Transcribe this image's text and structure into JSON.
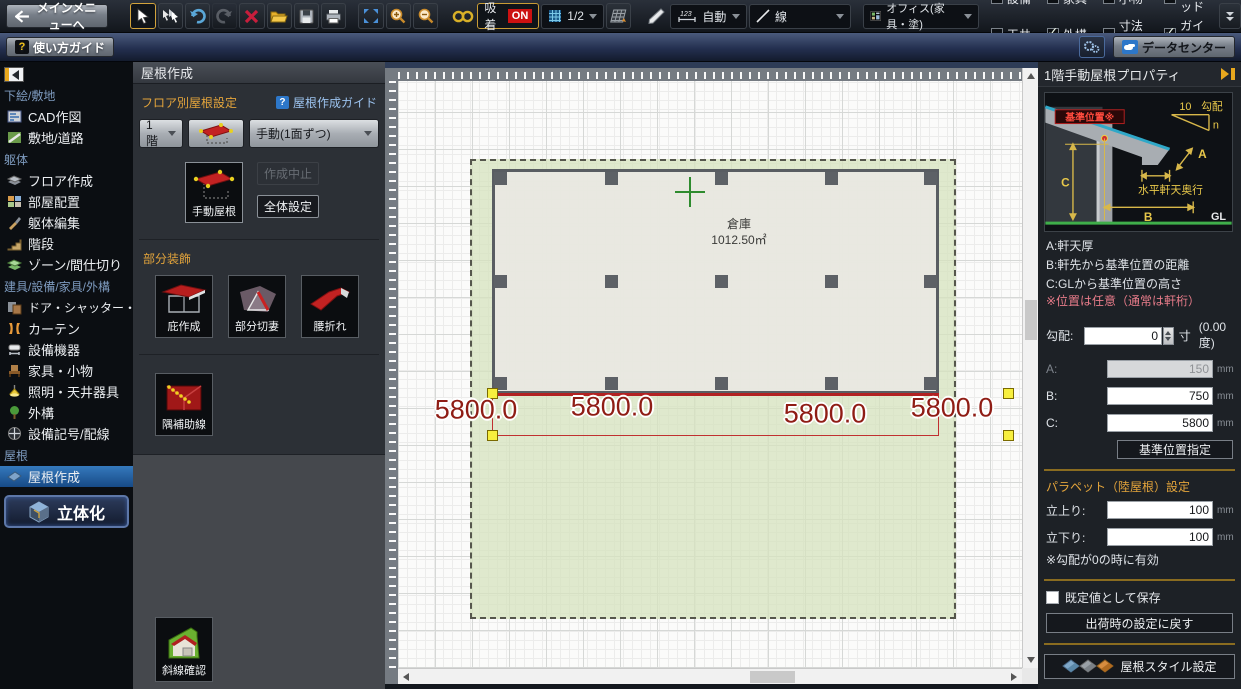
{
  "toolbar": {
    "main_menu_label": "メインメニューへ",
    "snap_label": "吸着",
    "snap_state": "ON",
    "grid_scale": "1/2",
    "dim_icon_text": "123",
    "dim_mode": "自動",
    "line_type": "線",
    "template_name": "オフィス(家具・塗)",
    "checkboxes": [
      {
        "label": "設備",
        "checked": false
      },
      {
        "label": "家具",
        "checked": false
      },
      {
        "label": "小物",
        "checked": false
      },
      {
        "label": "グリッド",
        "checked": true
      },
      {
        "label": "天井",
        "checked": false
      },
      {
        "label": "外構",
        "checked": true
      },
      {
        "label": "寸法線",
        "checked": false
      },
      {
        "label": "ガイド線",
        "checked": true
      }
    ]
  },
  "guide_bar": {
    "help_glyph": "?",
    "usage_guide": "使い方ガイド",
    "data_center": "データセンター"
  },
  "sidebar": {
    "sections": [
      {
        "label": "下絵/敷地",
        "items": [
          {
            "label": "CAD作図"
          },
          {
            "label": "敷地/道路"
          }
        ]
      },
      {
        "label": "躯体",
        "items": [
          {
            "label": "フロア作成"
          },
          {
            "label": "部屋配置"
          },
          {
            "label": "躯体編集"
          },
          {
            "label": "階段"
          },
          {
            "label": "ゾーン/間仕切り"
          }
        ]
      },
      {
        "label": "建具/設備/家具/外構",
        "items": [
          {
            "label": "ドア・シャッター・窓"
          },
          {
            "label": "カーテン"
          },
          {
            "label": "設備機器"
          },
          {
            "label": "家具・小物"
          },
          {
            "label": "照明・天井器具"
          },
          {
            "label": "外構"
          },
          {
            "label": "設備記号/配線"
          }
        ]
      },
      {
        "label": "屋根",
        "items": [
          {
            "label": "屋根作成",
            "selected": true
          }
        ]
      }
    ],
    "solid_button": "立体化"
  },
  "panel": {
    "title": "屋根作成",
    "floor_setting_label": "フロア別屋根設定",
    "guide_glyph": "?",
    "guide_link": "屋根作成ガイド",
    "floor_select": "1階",
    "method_select": "手動(1面ずつ)",
    "manual_roof": "手動屋根",
    "cancel_create": "作成中止",
    "overall_setting": "全体設定",
    "decoration_label": "部分装飾",
    "deco_buttons": [
      {
        "label": "庇作成"
      },
      {
        "label": "部分切妻"
      },
      {
        "label": "腰折れ"
      }
    ],
    "aux_button": "隅補助線",
    "slant_check": "斜線確認"
  },
  "canvas": {
    "room": {
      "name": "倉庫",
      "area": "1012.50㎡"
    },
    "dim_labels": [
      "5800.0",
      "5800.0",
      "5800.0",
      "5800.0"
    ]
  },
  "properties": {
    "title": "1階手動屋根プロパティ",
    "diagram": {
      "base_label": "基準位置※",
      "slope_num": "10",
      "slope_label": "勾配",
      "slope_n": "n",
      "a": "A",
      "b": "B",
      "c": "C",
      "eave_label": "水平軒天奥行",
      "gl": "GL"
    },
    "notes": [
      "A:軒天厚",
      "B:軒先から基準位置の距離",
      "C:GLから基準位置の高さ"
    ],
    "note_warning": "※位置は任意（通常は軒桁）",
    "slope": {
      "label": "勾配:",
      "value": "0",
      "unit": "寸",
      "degrees": "(0.00度)"
    },
    "fields": [
      {
        "label": "A:",
        "value": "150",
        "unit": "mm",
        "disabled": true
      },
      {
        "label": "B:",
        "value": "750",
        "unit": "mm",
        "disabled": false
      },
      {
        "label": "C:",
        "value": "5800",
        "unit": "mm",
        "disabled": false
      }
    ],
    "base_position_button": "基準位置指定",
    "parapet": {
      "title": "パラペット（陸屋根）設定",
      "fields": [
        {
          "label": "立上り:",
          "value": "100",
          "unit": "mm"
        },
        {
          "label": "立下り:",
          "value": "100",
          "unit": "mm"
        }
      ],
      "note": "※勾配が0の時に有効"
    },
    "save_default_label": "既定値として保存",
    "reset_button": "出荷時の設定に戻す",
    "roof_style_button": "屋根スタイル設定"
  },
  "icons": {
    "select-cursor": "arrow pointer",
    "multi-select": "triple arrows",
    "undo": "blue curved arrow",
    "redo": "gray curved arrow",
    "delete": "red x",
    "open-folder": "yellow folder",
    "save": "floppy disk",
    "print": "printer",
    "fit-view": "blue expand arrows",
    "zoom-in": "magnifier plus",
    "zoom-out": "magnifier minus",
    "snap-chain": "gold link",
    "grid": "blue grid",
    "angle-grid": "slanted grid",
    "measure-pen": "white pen",
    "gear": "settings gears",
    "cloud": "blue cloud",
    "solid-cube": "3d cube",
    "roof-tiles": "colored roof tiles"
  },
  "colors": {
    "accent_orange": "#e3a43b",
    "selected_blue": "#2f6fb4",
    "roof_red": "#c32222",
    "handle_yellow": "#f7ef3e",
    "dim_red": "#8f1d15",
    "site_green": "#d5e3be"
  }
}
